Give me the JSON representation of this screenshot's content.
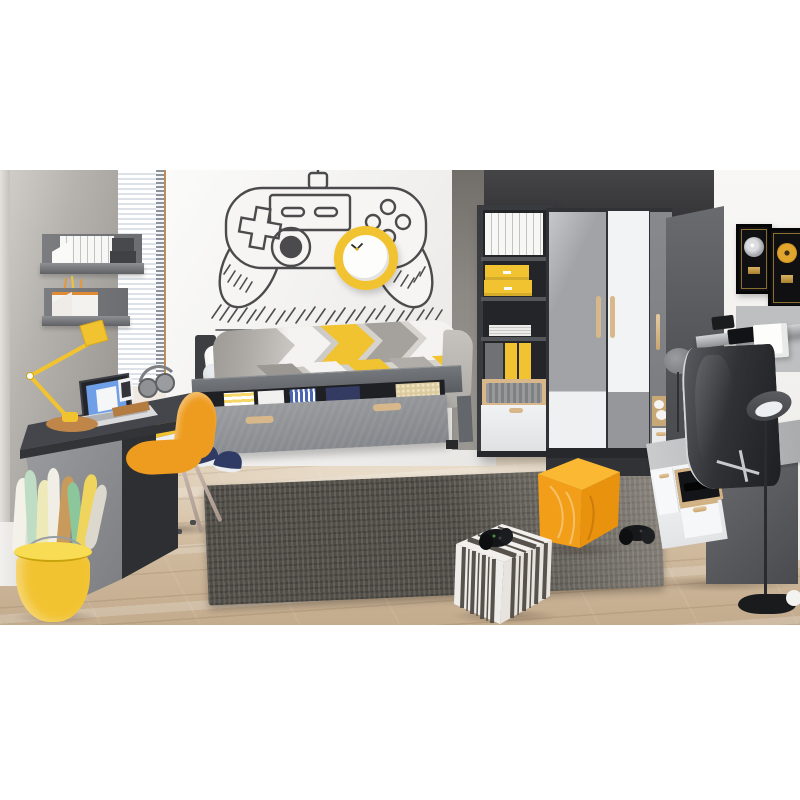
{
  "image": {
    "type": "furniture showroom product photo",
    "description": "Teen bedroom furniture set in graphite grey, white and oak with yellow accents: a hand-drawn gamepad wall decal with a yellow clock, a single storage bed with chevron duvet, a grey desk with laptop and orange shell chair, wall shelves, a tall bookcase, a corner wardrobe, a TV unit with curved TV, framed gold records, an orange cube pouf and a striped pouf with gamepads on a dark rug over light oak flooring."
  },
  "palette": {
    "accent_yellow": "#f2c331",
    "chair_orange": "#ee9c1f",
    "pouf_orange_top": "#fbb833",
    "pouf_orange_front": "#f29e18",
    "pouf_orange_side": "#e8920e",
    "oak": "#d8b88a",
    "anthracite": "#3b3d41",
    "mid_gray": "#9a9da1",
    "white_furniture": "#f2f3f4",
    "wall_charcoal": "#3c3c3e",
    "wall_concrete": "#a9a6a1",
    "rug_charcoal": "#524f49",
    "floor_wood": "#d4c0a5",
    "navy": "#2f3a65"
  },
  "scene": {
    "objects": {
      "wall_decal": {
        "label": "hand-drawn gamepad wall decal"
      },
      "wall_clock": {
        "label": "round yellow wall clock"
      },
      "wall_shelf_upper": {
        "label": "grey wall shelf with white binders and dark storage boxes"
      },
      "wall_shelf_lower": {
        "label": "grey wall shelf with magazine files and pens"
      },
      "window": {
        "label": "window with white venetian blinds"
      },
      "desk": {
        "label": "graphite desk with yellow drawer unit"
      },
      "laptop": {
        "label": "open laptop"
      },
      "desk_lamp": {
        "label": "yellow articulated desk lamp"
      },
      "headphones": {
        "label": "grey headphones"
      },
      "smartphone": {
        "label": "smartphone in dock"
      },
      "chair": {
        "label": "orange shell chair on beige legs"
      },
      "paper_bin": {
        "label": "yellow bin with rolled posters"
      },
      "bed": {
        "label": "single bed with open under-bed storage drawer"
      },
      "pillows": {
        "label": "white pillows"
      },
      "duvet": {
        "label": "grey, white and yellow chevron duvet"
      },
      "bed_drawer": {
        "label": "open under-bed drawer with folded clothes"
      },
      "sneakers": {
        "label": "navy sneakers on floor"
      },
      "bookcase": {
        "label": "tall graphite bookcase with binders, yellow boxes and folders"
      },
      "wardrobe": {
        "label": "corner wardrobe with grey and white doors and oak handles"
      },
      "wardrobe_side": {
        "label": "wardrobe side unit with open oak shelves"
      },
      "wall_lamp": {
        "label": "round grey wall lamp"
      },
      "record_frame_silver": {
        "label": "framed silver record award"
      },
      "record_frame_gold": {
        "label": "framed gold record award"
      },
      "media_shelf": {
        "label": "wall panel shelf with speaker and console"
      },
      "tv": {
        "label": "curved television"
      },
      "tv_stand": {
        "label": "TV stand with open media compartment"
      },
      "floor_lamp": {
        "label": "black floor lamp"
      },
      "rug": {
        "label": "dark grey textured rug"
      },
      "pouf_orange": {
        "label": "orange cube pouf"
      },
      "pouf_striped": {
        "label": "striped cube pouf with black gamepad"
      },
      "gamepad_floor": {
        "label": "black gamepad on the floor"
      },
      "floor": {
        "label": "light oak wood floor"
      }
    }
  }
}
